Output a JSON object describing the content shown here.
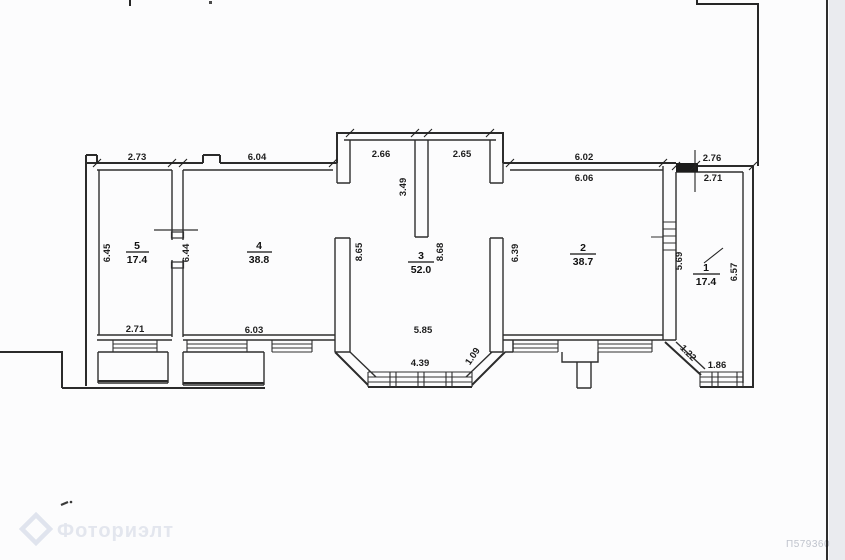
{
  "watermark": {
    "brand": "Фоториэлт",
    "doc_id": "П579360"
  },
  "rooms": {
    "r1": {
      "number": "1",
      "area": "17.4"
    },
    "r2": {
      "number": "2",
      "area": "38.7"
    },
    "r3": {
      "number": "3",
      "area": "52.0"
    },
    "r4": {
      "number": "4",
      "area": "38.8"
    },
    "r5": {
      "number": "5",
      "area": "17.4"
    }
  },
  "dimensions": {
    "room5_top": "2.73",
    "room4_top": "6.04",
    "hall_top_left": "2.66",
    "hall_top_right": "2.65",
    "room2_top_outer": "6.02",
    "room2_top_inner": "6.06",
    "room1_top_outer": "2.76",
    "room1_top_inner": "2.71",
    "room5_left": "6.45",
    "wall_5_4": "6.44",
    "room4_right": "8.65",
    "hall_stub": "3.49",
    "hall_center": "8.68",
    "room2_left": "6.39",
    "room1_left": "5.69",
    "room1_right": "6.57",
    "room5_bottom": "2.71",
    "room4_bottom": "6.03",
    "hall_bottom": "5.85",
    "bay_window": "4.39",
    "bay_diagonal": "1.09",
    "room1_diagonal": "1.22",
    "room1_window": "1.86"
  }
}
